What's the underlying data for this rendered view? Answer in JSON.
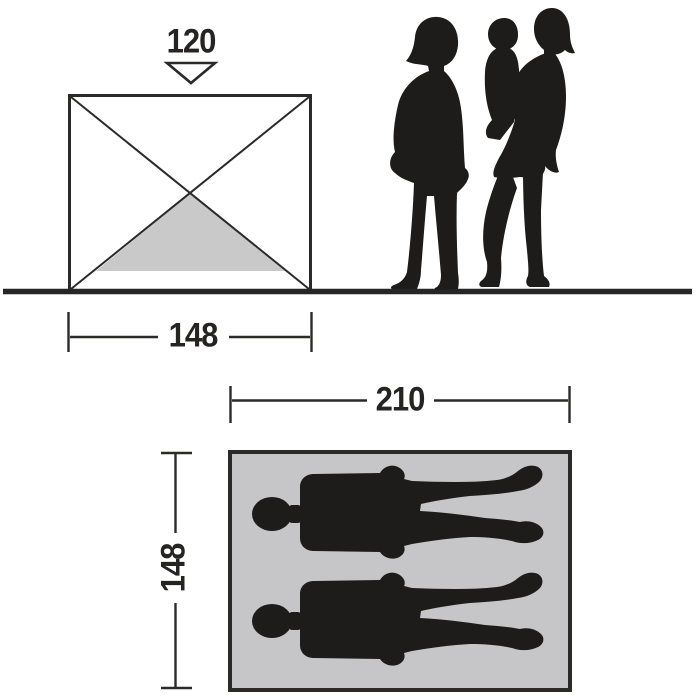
{
  "front_elevation": {
    "height_label": "120",
    "width_label": "148",
    "height_arrow_icon": "triangle-down-outline",
    "inner_shade_icon": "inner-tent-triangle"
  },
  "scale_figures": {
    "icon": "family-silhouette",
    "figures": "two adults standing, one holding a child"
  },
  "floor_plan": {
    "length_label": "210",
    "depth_label": "148",
    "occupants": 2,
    "occupant_icon": "lying-person-silhouette"
  },
  "colors": {
    "line": "#2b2a29",
    "silhouette": "#1e1c1a",
    "floor_fill": "#c6c6c8",
    "shade_fill": "#c9c9c9",
    "marker_fill": "#ffffff",
    "text": "#252422",
    "background": "#ffffff"
  }
}
